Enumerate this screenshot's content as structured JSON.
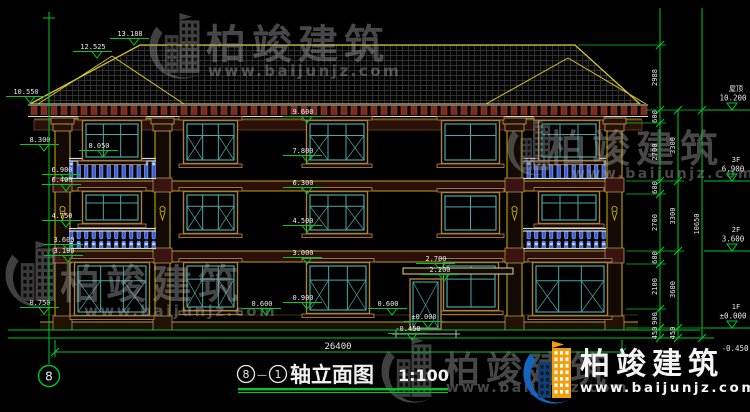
{
  "watermark": {
    "brand": "柏竣建筑",
    "url": "www.baijunjz.com"
  },
  "title": {
    "axis_from": "8",
    "separator": "—",
    "axis_to": "1",
    "text": "轴立面图",
    "scale": "1:100"
  },
  "axis_bubble_label": "8",
  "bottom_dim": "26400",
  "colors": {
    "dim_green": "#00c828",
    "roof_yellow": "#d6c62e",
    "window_cyan": "#4aa8a8",
    "baluster_blue": "#3c5fd8",
    "band_red": "#3a1410",
    "logo_blue": "#1565c0",
    "logo_orange": "#f59e0b"
  },
  "elevation_markers": [
    {
      "t": "13.188",
      "px": 134,
      "py": 45
    },
    {
      "t": "12.525",
      "px": 97,
      "py": 58
    },
    {
      "t": "10.550",
      "px": 30,
      "py": 103
    },
    {
      "t": "8.300",
      "px": 44,
      "py": 151
    },
    {
      "t": "8.050",
      "px": 103,
      "py": 157
    },
    {
      "t": "6.900",
      "px": 66,
      "py": 181
    },
    {
      "t": "6.400",
      "px": 66,
      "py": 191
    },
    {
      "t": "4.750",
      "px": 66,
      "py": 227
    },
    {
      "t": "3.600",
      "px": 68,
      "py": 251
    },
    {
      "t": "3.100",
      "px": 68,
      "py": 262
    },
    {
      "t": "0.750",
      "px": 44,
      "py": 314
    },
    {
      "t": "9.600",
      "px": 307,
      "py": 123
    },
    {
      "t": "7.800",
      "px": 307,
      "py": 162
    },
    {
      "t": "6.300",
      "px": 307,
      "py": 194
    },
    {
      "t": "4.500",
      "px": 307,
      "py": 232
    },
    {
      "t": "3.000",
      "px": 307,
      "py": 264
    },
    {
      "t": "0.900",
      "px": 307,
      "py": 309
    },
    {
      "t": "0.600",
      "px": 266,
      "py": 315
    },
    {
      "t": "0.600",
      "px": 392,
      "py": 315
    },
    {
      "t": "2.700",
      "px": 440,
      "py": 270
    },
    {
      "t": "2.200",
      "px": 444,
      "py": 281
    },
    {
      "t": "±0.000",
      "px": 428,
      "py": 328
    },
    {
      "t": "-0.450",
      "px": 412,
      "py": 340
    }
  ],
  "dim_chains": [
    {
      "x": 660,
      "ext_top": 8,
      "segs": [
        {
          "v": "2988",
          "y1": 45,
          "y2": 110
        },
        {
          "v": "600",
          "y1": 110,
          "y2": 123
        },
        {
          "v": "2700",
          "y1": 123,
          "y2": 181
        },
        {
          "v": "600",
          "y1": 181,
          "y2": 194
        },
        {
          "v": "2700",
          "y1": 194,
          "y2": 251
        },
        {
          "v": "600",
          "y1": 251,
          "y2": 264
        },
        {
          "v": "2100",
          "y1": 264,
          "y2": 309
        },
        {
          "v": "900",
          "y1": 309,
          "y2": 328
        },
        {
          "v": "450",
          "y1": 328,
          "y2": 338
        }
      ]
    },
    {
      "x": 678,
      "segs": [
        {
          "v": "3300",
          "y1": 110,
          "y2": 181
        },
        {
          "v": "3300",
          "y1": 181,
          "y2": 251
        },
        {
          "v": "3600",
          "y1": 251,
          "y2": 328
        },
        {
          "v": "450",
          "y1": 328,
          "y2": 338
        }
      ]
    },
    {
      "x": 702,
      "ext_top": 8,
      "segs": [
        {
          "v": "10650",
          "y1": 110,
          "y2": 338
        }
      ]
    }
  ],
  "levels": [
    {
      "label": "屋顶",
      "value": "10.200",
      "y": 110,
      "flag": true
    },
    {
      "label": "3F",
      "value": "6.900",
      "y": 181,
      "flag": true
    },
    {
      "label": "2F",
      "value": "3.600",
      "y": 251,
      "flag": true
    },
    {
      "label": "1F",
      "value": "±0.000",
      "y": 328,
      "flag": true
    },
    {
      "label": "",
      "value": "-0.450",
      "y": 338,
      "flag": false
    }
  ]
}
